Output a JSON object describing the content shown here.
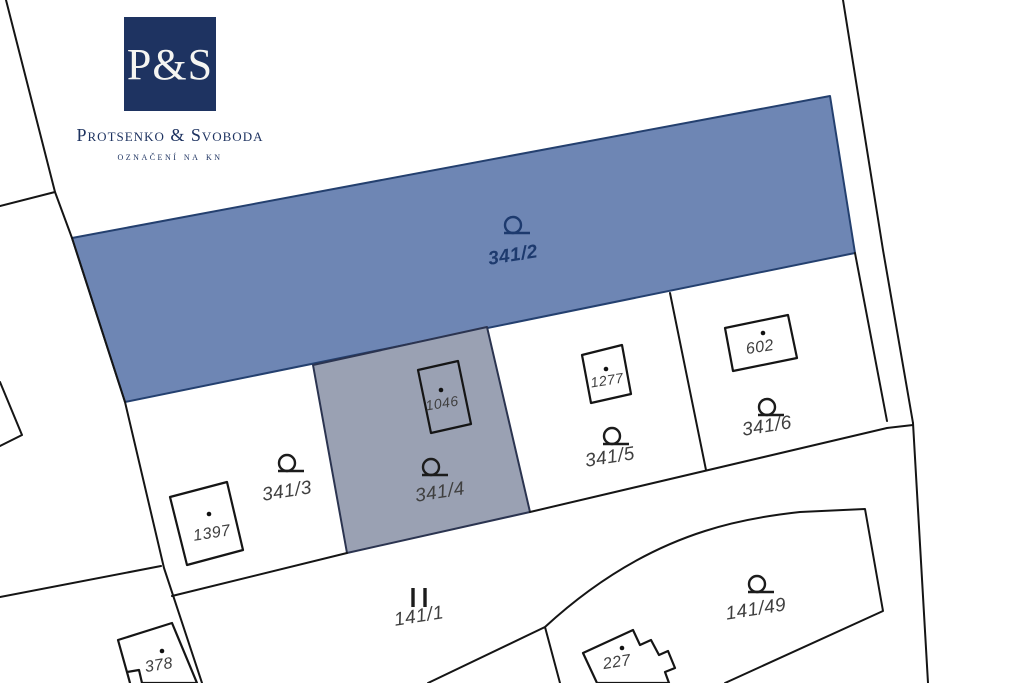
{
  "logo": {
    "monogram": "P&S",
    "name": "Protsenko & Svoboda",
    "tagline": "označení na kn"
  },
  "map": {
    "parcels": [
      {
        "id": "341/2",
        "label": "341/2",
        "symbol": "garden-icon",
        "highlight": "blue"
      },
      {
        "id": "341/3",
        "label": "341/3",
        "symbol": "garden-icon",
        "highlight": "none"
      },
      {
        "id": "341/4",
        "label": "341/4",
        "symbol": "garden-icon",
        "highlight": "gray"
      },
      {
        "id": "341/5",
        "label": "341/5",
        "symbol": "garden-icon",
        "highlight": "none"
      },
      {
        "id": "341/6",
        "label": "341/6",
        "symbol": "garden-icon",
        "highlight": "none"
      },
      {
        "id": "141/1",
        "label": "141/1",
        "symbol": "road-bars-icon",
        "highlight": "none"
      },
      {
        "id": "141/49",
        "label": "141/49",
        "symbol": "garden-icon",
        "highlight": "none"
      }
    ],
    "buildings": [
      {
        "label": "1046"
      },
      {
        "label": "1277"
      },
      {
        "label": "602"
      },
      {
        "label": "1397"
      },
      {
        "label": "378"
      },
      {
        "label": "227"
      }
    ],
    "colors": {
      "highlight_blue": "#6e86b4",
      "highlight_blue_border": "#24406f",
      "highlight_gray": "#9aa1b3",
      "line": "#151515",
      "label": "#3f3f3f",
      "label_on_blue": "#1d3a6e",
      "logo_navy": "#1e3361"
    }
  }
}
